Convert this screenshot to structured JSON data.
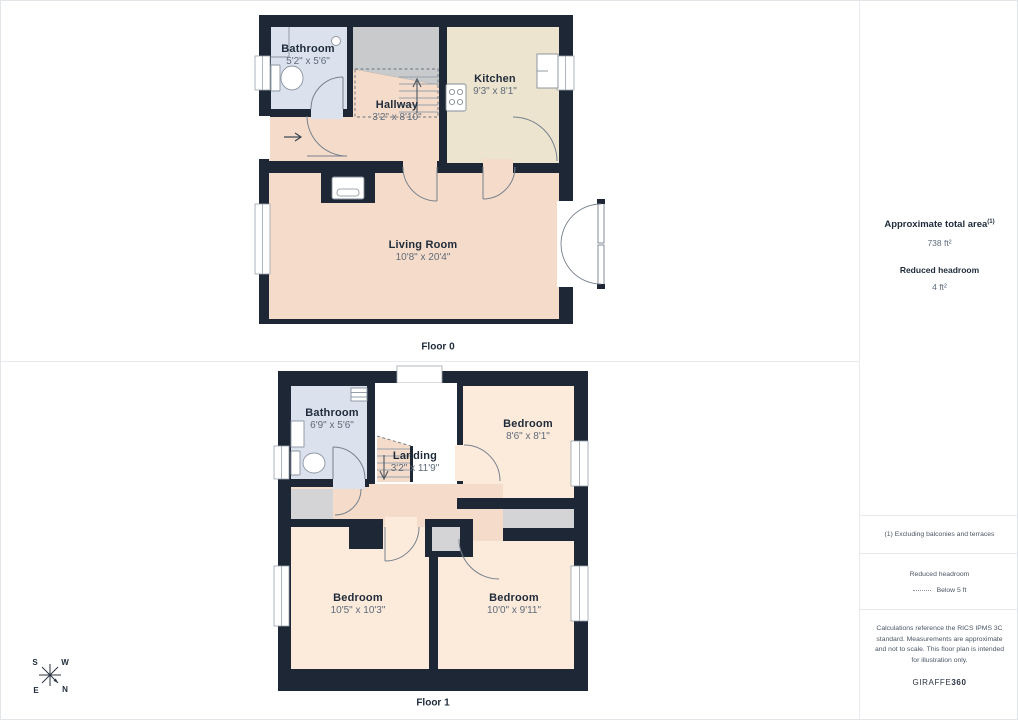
{
  "floor0": {
    "caption": "Floor 0",
    "rooms": [
      {
        "name": "Bathroom",
        "dims": "5'2\" x 5'6\""
      },
      {
        "name": "Hallway",
        "dims": "3'2\" x 8'10\""
      },
      {
        "name": "Kitchen",
        "dims": "9'3\" x 8'1\""
      },
      {
        "name": "Living Room",
        "dims": "10'8\" x 20'4\""
      }
    ]
  },
  "floor1": {
    "caption": "Floor 1",
    "rooms": [
      {
        "name": "Bathroom",
        "dims": "6'9\" x 5'6\""
      },
      {
        "name": "Landing",
        "dims": "3'2\" x 11'9\""
      },
      {
        "name": "Bedroom",
        "dims": "8'6\" x 8'1\""
      },
      {
        "name": "Bedroom",
        "dims": "10'5\" x 10'3\""
      },
      {
        "name": "Bedroom",
        "dims": "10'0\" x 9'11\""
      }
    ]
  },
  "sidebar": {
    "total_area_label": "Approximate total area",
    "total_area_superscript": "(1)",
    "total_area_value": "738 ft²",
    "reduced_headroom_label": "Reduced headroom",
    "reduced_headroom_value": "4 ft²",
    "footnote": "(1) Excluding balconies and terraces",
    "legend_label": "Reduced headroom",
    "legend_value": "Below 5 ft",
    "disclaimer": "Calculations reference the RICS IPMS 3C standard. Measurements are approximate and not to scale. This floor plan is intended for illustration only.",
    "brand_normal": "GIRAFFE",
    "brand_bold": "360"
  },
  "compass": {
    "n": "N",
    "s": "S",
    "e": "E",
    "w": "W"
  },
  "colors": {
    "wall": "#1d2735",
    "bathroom": "#dce1ee",
    "kitchen": "#ece4cf",
    "living": "#f5dcca",
    "bedroom": "#fceadb",
    "stairs": "#c8cacc",
    "closet": "#d4d4d6"
  }
}
